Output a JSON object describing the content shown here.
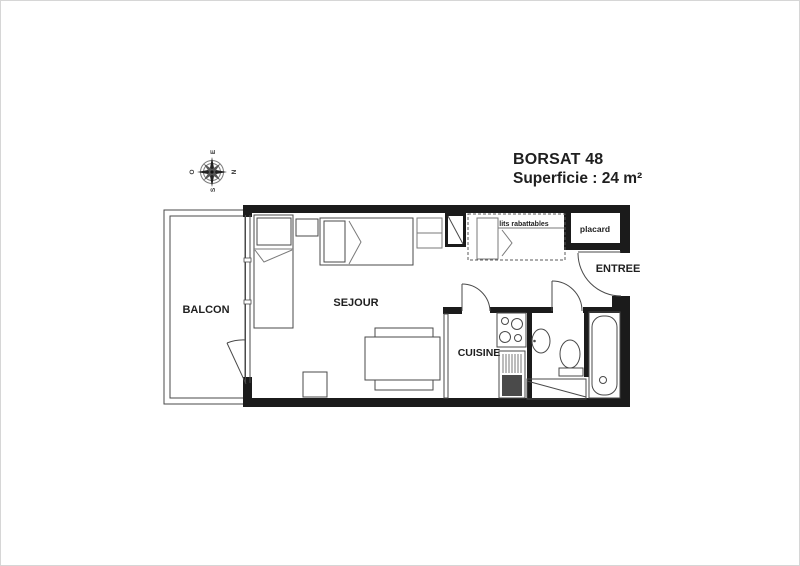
{
  "title": {
    "name": "BORSAT 48",
    "superficie": "Superficie : 24 m²"
  },
  "rooms": {
    "balcon": "BALCON",
    "sejour": "SEJOUR",
    "cuisine": "CUISINE",
    "entree": "ENTREE",
    "placard": "placard",
    "lits_rabattables": "lits rabattables"
  },
  "compass": {
    "top": "E",
    "right": "N",
    "bottom": "S",
    "left": "O"
  },
  "colors": {
    "wall": "#1b1b1b",
    "line": "#4a4a4a",
    "text": "#1f1f1f"
  }
}
